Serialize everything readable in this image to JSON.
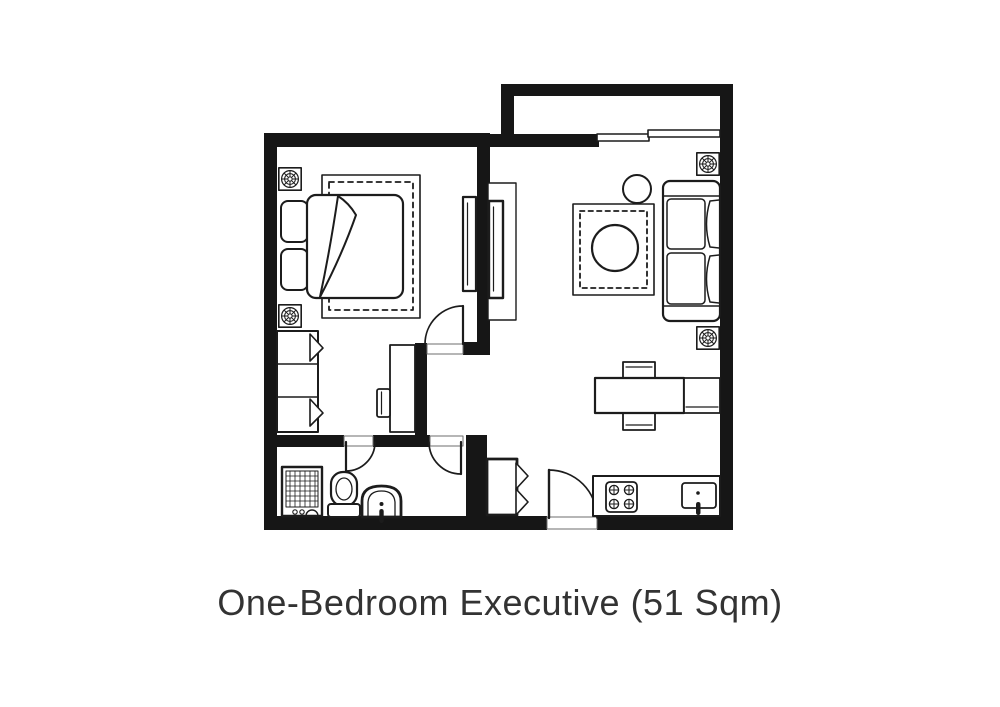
{
  "caption": "One-Bedroom Executive (51 Sqm)",
  "colors": {
    "background": "#ffffff",
    "walls": "#161616",
    "furniture_lines": "#1c1c1c",
    "caption_text": "#333333"
  }
}
